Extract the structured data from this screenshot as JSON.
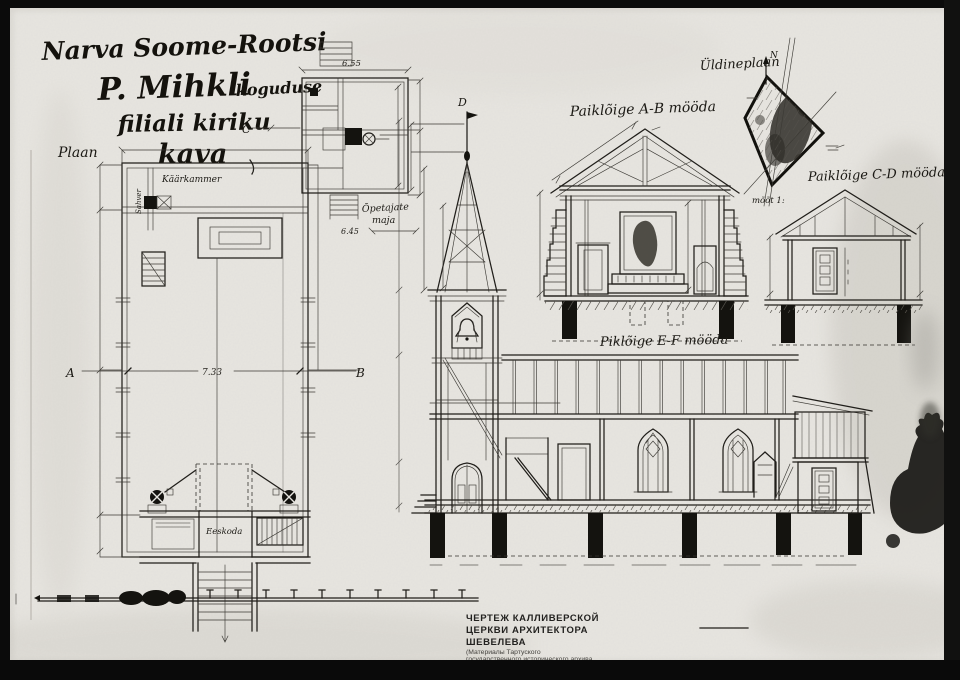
{
  "artwork": {
    "kind": "scanned architectural drawing of a church",
    "paper_color": "#e7e5e0",
    "ink_color": "#1d1b16",
    "frame_color": "#0b0b0b"
  },
  "title": {
    "line1": "Narva Soome-Rootsi",
    "line2a": "P. Mihkli",
    "line2b": "koguduse",
    "line3": "filiali kiriku",
    "line4": "kava"
  },
  "plan": {
    "label": "Plaan",
    "rooms": {
      "sacristy": "Käärkammer",
      "pantry": "Sahver",
      "vestibule": "Eeskoda"
    },
    "width_dim": "7.33",
    "markers": {
      "a": "A",
      "b": "B",
      "c": "C",
      "d": "D"
    }
  },
  "teachers_house": {
    "label_line1": "Õpetajate",
    "label_line2": "maja",
    "width_dim": "6.55",
    "depth_dim": "6.45"
  },
  "sections": {
    "ab_label": "Paiklõige A-B mööda",
    "cd_label": "Paiklõige C-D mööda",
    "ef_label": "Piklõige E-F mööda"
  },
  "site_plan": {
    "label": "Üldineplaan",
    "north_marker": "N",
    "scale_note": "mõõt 1:"
  },
  "stamp": {
    "line1": "ЧЕРТЕЖ КАЛЛИВЕРСКОЙ",
    "line2": "ЦЕРКВИ АРХИТЕКТОРА",
    "line3": "ШЕВЕЛЕВА",
    "line4": "(Материалы Тартуского",
    "line5": "государственного исторического архива",
    "line6": "Эстонии)"
  }
}
